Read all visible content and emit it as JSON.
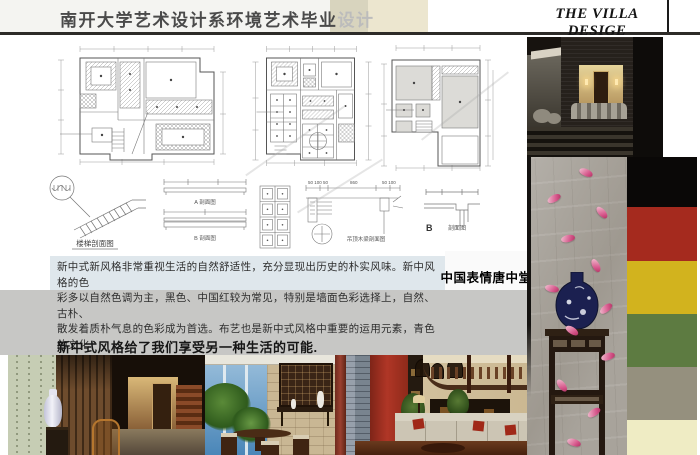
{
  "header": {
    "title_main": "南开大学艺术设计系环境艺术毕业",
    "title_accent": "设计",
    "logo": "THE VILLA DESIGE"
  },
  "details": {
    "stair_label": "楼梯剖面图",
    "beam_a_label": "A 剖面图",
    "beam_b_label": "B 剖面图",
    "joist_label": "吊顶木梁剖面图",
    "joist_dim_left": "50 100 50",
    "joist_dim_mid": "860",
    "joist_dim_right": "50 100",
    "b_detail_letter": "B",
    "b_detail_label": "剖面图"
  },
  "body": {
    "paragraph_lines": [
      "新中式新风格非常重视生活的自然舒适性，充分显现出历史的朴实风味。新中风格的色",
      "彩多以自然色调为主，黑色、中国红较为常见，特别是墙面色彩选择上，自然、古朴、",
      "散发着质朴气息的色彩成为首选。布艺也是新中式风格中重要的运用元素，青色的文化",
      "石，显示、了文化的气质、用中国典型的传统色彩，演绎新中式 。"
    ],
    "tang_caption": "中国表情唐中堂",
    "bottom_heading": "新中式风格给了我们享受另一种生活的可能."
  },
  "palette": {
    "black": "#0a0807",
    "chinese_red": "#a52a1e",
    "gold_yellow": "#d2b31e",
    "green": "#5d7b41",
    "warm_gray": "#95907e",
    "cream": "#efecc4"
  }
}
